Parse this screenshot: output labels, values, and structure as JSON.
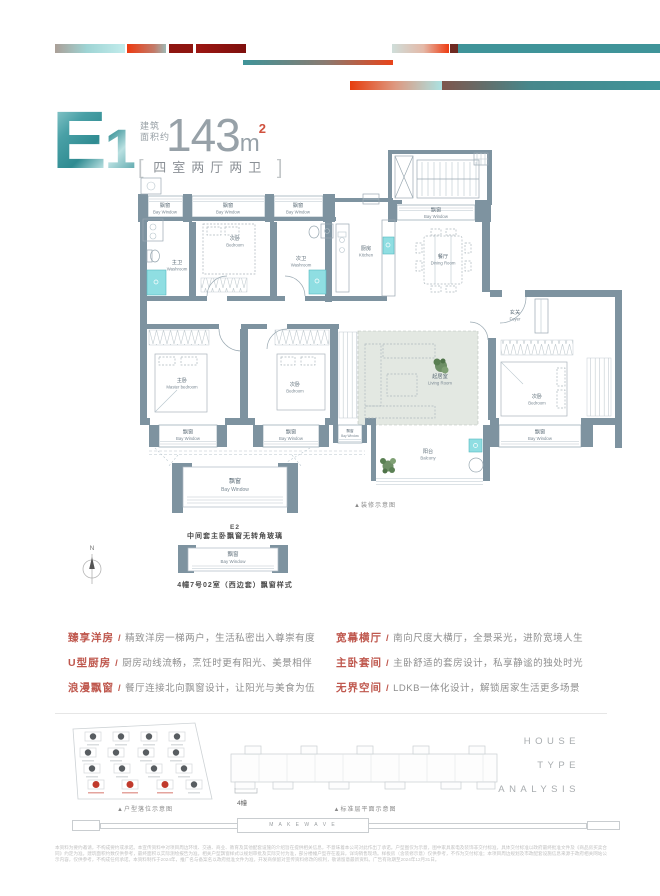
{
  "colors": {
    "wall_slate": "#7E93A0",
    "accent_teal": "#3F9499",
    "accent_red": "#E8441A",
    "dark_red": "#8E1510",
    "keyword_red": "#BF574D",
    "fixture_cyan": "#8FDEE2",
    "highlight_building_red": "#C0392B",
    "living_room_fill": "#E3E8E2"
  },
  "header": {
    "plan_code_main": "E",
    "plan_code_sub": "1",
    "area_label_line1": "建筑",
    "area_label_line2": "面积约",
    "area_number": "143",
    "area_unit": "m",
    "area_sup": "2",
    "bracket_left": "[",
    "bracket_right": "]",
    "layout": "四室两厅两卫"
  },
  "plan": {
    "rooms": {
      "bay_window": {
        "cn": "飘窗",
        "en": "Bay Window"
      },
      "bedroom": {
        "cn": "次卧",
        "en": "Bedroom"
      },
      "master_washroom": {
        "cn": "主卫",
        "en": "Washroom"
      },
      "second_washroom": {
        "cn": "次卫",
        "en": "Washroom"
      },
      "kitchen": {
        "cn": "厨房",
        "en": "Kitchen"
      },
      "dining_room": {
        "cn": "餐厅",
        "en": "Dining Room"
      },
      "foyer": {
        "cn": "玄关",
        "en": "Foyer"
      },
      "living_room": {
        "cn": "起居室",
        "en": "Living Room"
      },
      "master_bedroom": {
        "cn": "主卧",
        "en": "Master bedroom"
      },
      "balcony": {
        "cn": "阳台",
        "en": "Balcony"
      }
    }
  },
  "bay_diagrams": {
    "compass": "N",
    "deco_note": "▲装修示意图",
    "d1": {
      "label_cn": "飘窗",
      "label_en": "Bay Window",
      "caption1": "E2",
      "caption2": "中间套主卧飘窗无转角玻璃"
    },
    "d2": {
      "label_cn": "飘窗",
      "label_en": "Bay Window",
      "caption": "4幢7号02室（西边套）飘窗样式"
    }
  },
  "features": {
    "separator": "/",
    "left": [
      {
        "term": "臻享洋房",
        "desc": "精致洋房一梯两户，生活私密出入尊崇有度"
      },
      {
        "term": "U型厨房",
        "desc": "厨房动线流畅，烹饪时更有阳光、美景相伴"
      },
      {
        "term": "浪漫飘窗",
        "desc": "餐厅连接北向飘窗设计，让阳光与美食为伍"
      }
    ],
    "right": [
      {
        "term": "宽幕横厅",
        "desc": "南向尺度大横厅，全景采光，进阶宽境人生"
      },
      {
        "term": "主卧套间",
        "desc": "主卧舒适的套房设计，私享静谧的独处时光"
      },
      {
        "term": "无界空间",
        "desc": "LDKB一体化设计，解锁居家生活更多场景"
      }
    ]
  },
  "footer": {
    "site_plan_caption": "▲户型落位示意图",
    "floor_plan_caption": "▲标准层平面示意图",
    "building_tag": "4幢",
    "house_type": [
      "HOUSE",
      "TYPE",
      "ANALYSIS"
    ],
    "make_wave": "M A K E   W A V E",
    "disclaimer": "本资料为要约邀请，不构成要约或承诺。本宣传资料中对项目周边环境、交通、商业、教育及其他配套设施的介绍旨在提供相关信息，不意味着本公司对此作出了承诺。户型图仅为示意，图中家具家电及装饰非交付标准，具体交付标准以政府最终批准文件及《商品房买卖合同》约定为准。建筑面积约数仅供参考，最终面积以实际测绘报告为准。相关户型飘窗样式以规划审批及实际交付为准，部分楼幢户型存在差异，详询销售现场。样板房（含装修示意）仅供参考，不作为交付标准；本项目周边规划及市政配套设施信息来源于政府相关网站公示内容，仅供参考，不构成任何承诺。本资料制作于2024年，推广名与备案名以政府批准文件为准，开发商保留对宣传资料修改的权利，敬请留意最新资料。广告有效期至2024年12月31日。"
  }
}
